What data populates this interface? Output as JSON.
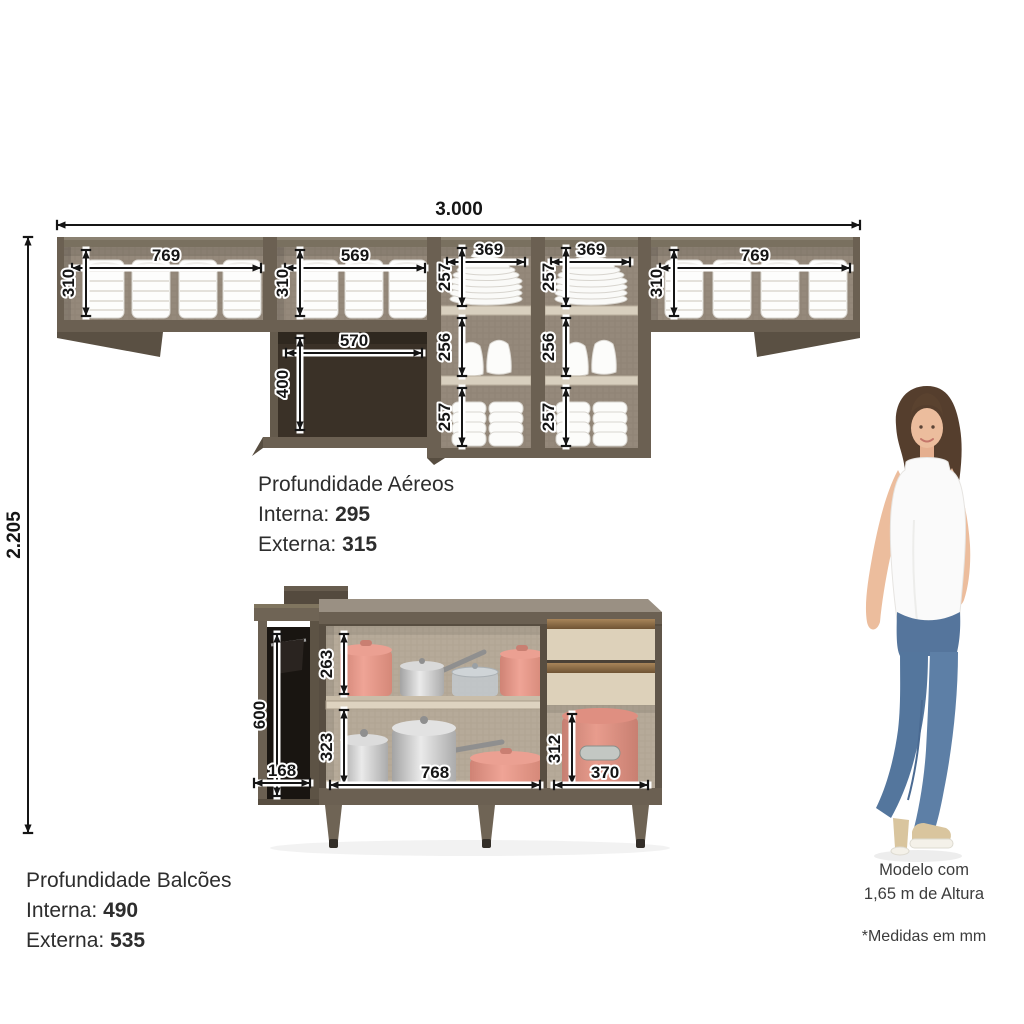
{
  "units_note": "*Medidas em mm",
  "overall": {
    "total_width": "3.000",
    "total_height": "2.205"
  },
  "wall": {
    "left_w": "769",
    "left_h": "310",
    "mid_w": "569",
    "mid_h": "310",
    "niche_w": "570",
    "niche_h": "400",
    "colA_w": "369",
    "colA_top": "257",
    "colA_mid": "256",
    "colA_bot": "257",
    "colB_w": "369",
    "colB_top": "257",
    "colB_mid": "256",
    "colB_bot": "257",
    "right_w": "769",
    "right_h": "310"
  },
  "base": {
    "tower_h": "600",
    "tower_w": "168",
    "shelf_top": "263",
    "shelf_bot": "323",
    "main_w": "768",
    "right_h": "312",
    "right_w": "370"
  },
  "aereos": {
    "title": "Profundidade Aéreos",
    "interna_label": "Interna:",
    "interna_value": "295",
    "externa_label": "Externa:",
    "externa_value": "315"
  },
  "balcoes": {
    "title": "Profundidade Balcões",
    "interna_label": "Interna:",
    "interna_value": "490",
    "externa_label": "Externa:",
    "externa_value": "535"
  },
  "model": {
    "line1": "Modelo com",
    "line2": "1,65 m de Altura"
  },
  "colors": {
    "frame": "#6b6052",
    "frame_dark": "#584e41",
    "wall_interior": "#95897b",
    "niche": "#3a3127",
    "base_interior": "#b6aa99",
    "drawer_face": "#ddd1ba",
    "drawer_handle": "#8a6c44",
    "pot_pink": "#e19487",
    "dim_line": "#151515"
  }
}
